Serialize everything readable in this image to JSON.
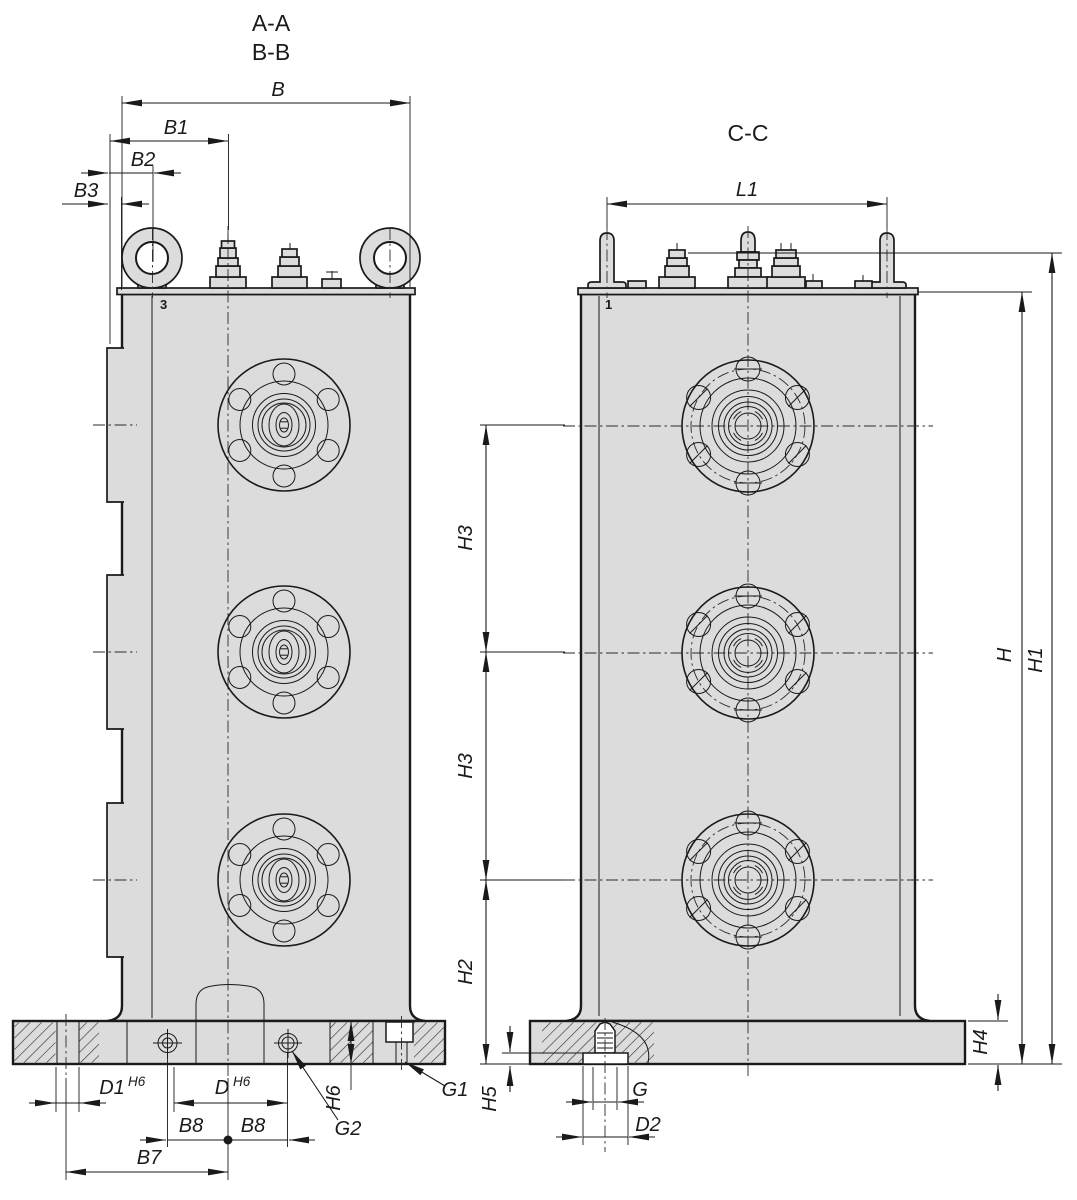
{
  "drawing": {
    "background": "#ffffff",
    "body_fill": "#dcdcdc",
    "line_color": "#1a1a1a",
    "views": {
      "left": {
        "section_label_1": "A-A",
        "section_label_2": "B-B",
        "item_marker": "3"
      },
      "right": {
        "section_label": "C-C",
        "item_marker": "1"
      }
    },
    "dim_labels": {
      "b": "B",
      "b1": "B1",
      "b2": "B2",
      "b3": "B3",
      "b7": "B7",
      "b8_left": "B8",
      "b8_right": "B8",
      "l1": "L1",
      "h": "H",
      "h1": "H1",
      "h2": "H2",
      "h3_upper": "H3",
      "h3_lower": "H3",
      "h4": "H4",
      "h5": "H5",
      "h6_base": "H6",
      "d": "D",
      "d_tol": "H6",
      "d1": "D1",
      "d1_tol": "H6",
      "d2": "D2",
      "g": "G",
      "g1": "G1",
      "g2": "G2"
    }
  }
}
